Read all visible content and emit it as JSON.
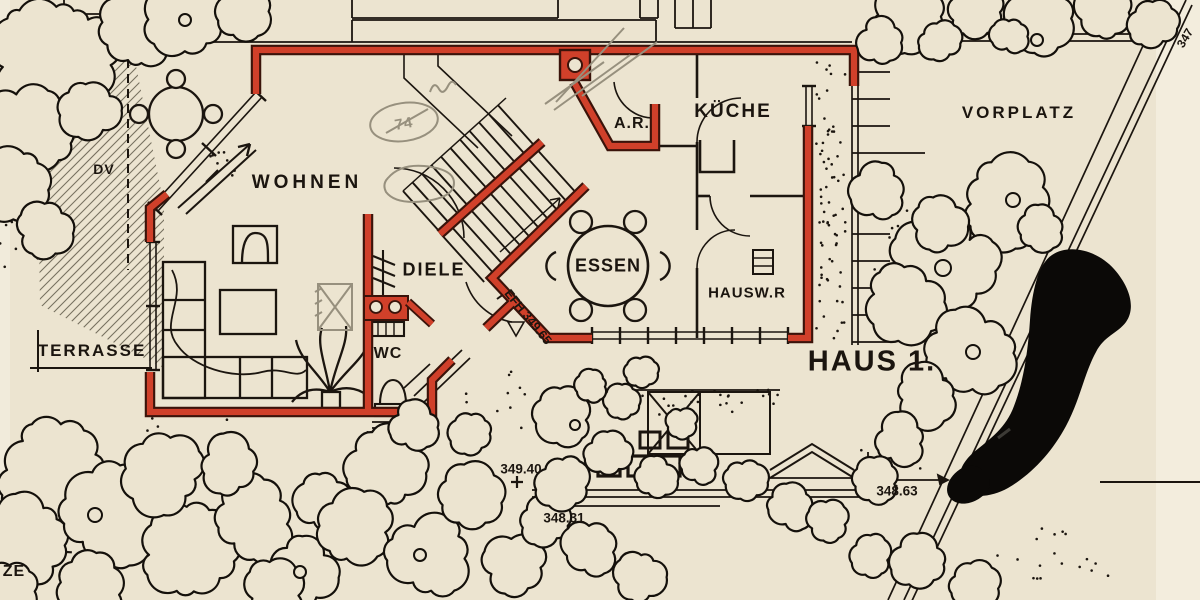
{
  "meta": {
    "drawing_title": "HAUS 1.",
    "sheet_type": "Lageplan / Grundriss Erdgeschoss"
  },
  "colors": {
    "paper": "#ece4d0",
    "wall_red": "#d0402a",
    "wall_dark": "#6e1c0d",
    "ink": "#1b150f",
    "pencil": "#97907e"
  },
  "rooms": {
    "wohnen": {
      "label": "WOHNEN"
    },
    "kueche": {
      "label": "KÜCHE"
    },
    "abstellraum": {
      "label": "A.R."
    },
    "essen": {
      "label": "ESSEN"
    },
    "diele": {
      "label": "DIELE"
    },
    "wc": {
      "label": "WC"
    },
    "hausw": {
      "label": "HAUSW.R"
    }
  },
  "site": {
    "terrasse": "TERRASSE",
    "vorplatz": "VORPLATZ",
    "dv": "DV",
    "haus": "HAUS 1.",
    "boundary_partial": "ZE",
    "corner_number": "347"
  },
  "elevations": {
    "point_terrain_1": "349.40",
    "point_terrain_2": "348.31",
    "point_terrain_3": "348.63",
    "floor_level": "EFH 349.65"
  },
  "annotations": {
    "pencil_circled": "74"
  }
}
